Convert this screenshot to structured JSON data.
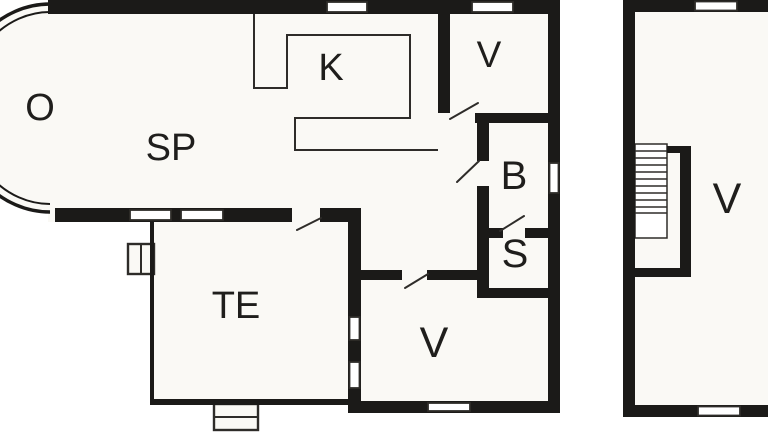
{
  "plan": {
    "type": "floor-plan",
    "colors": {
      "wall": "#1b1a18",
      "floor": "#faf9f5",
      "background": "#ffffff",
      "line": "#2e2c29",
      "label": "#1f1e1c"
    },
    "rooms": [
      {
        "id": "o",
        "label": "O"
      },
      {
        "id": "sp",
        "label": "SP"
      },
      {
        "id": "k",
        "label": "K"
      },
      {
        "id": "v-top",
        "label": "V"
      },
      {
        "id": "b",
        "label": "B"
      },
      {
        "id": "s",
        "label": "S"
      },
      {
        "id": "te",
        "label": "TE"
      },
      {
        "id": "v-bottom",
        "label": "V"
      },
      {
        "id": "v-annex",
        "label": "V"
      }
    ],
    "symbols": [
      "window",
      "door-swing",
      "staircase",
      "chimney",
      "entrance-step",
      "curved-wall"
    ]
  }
}
